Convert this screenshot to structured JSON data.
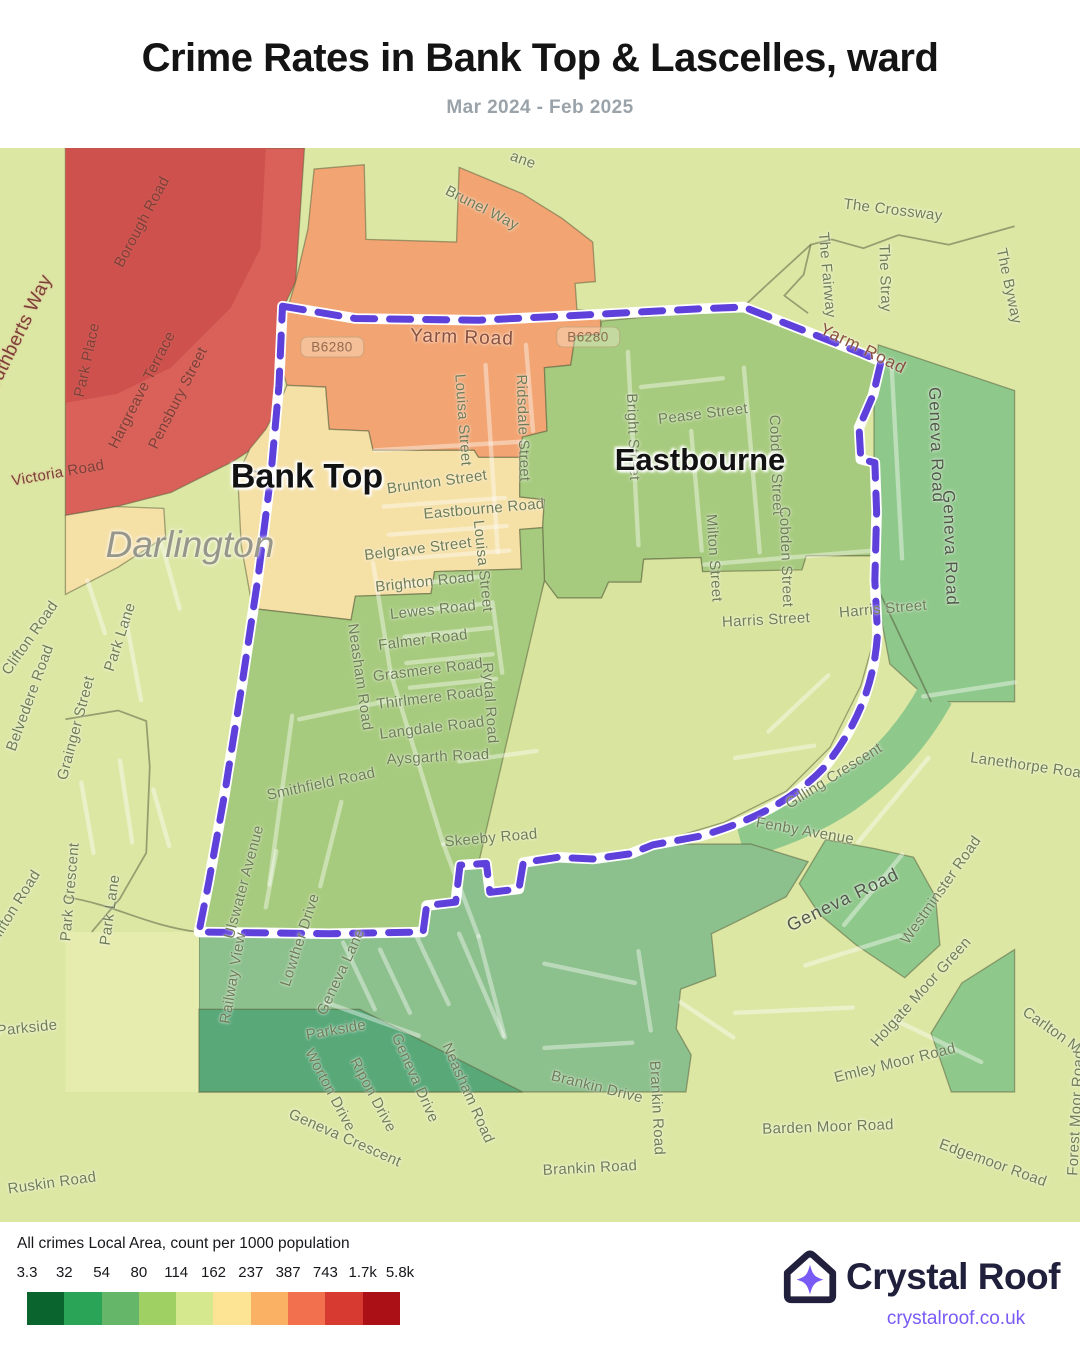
{
  "header": {
    "title": "Crime Rates in Bank Top & Lascelles, ward",
    "subtitle": "Mar 2024 - Feb 2025"
  },
  "legend": {
    "caption": "All crimes Local Area, count per 1000 population",
    "ticks": [
      "3.3",
      "32",
      "54",
      "80",
      "114",
      "162",
      "237",
      "387",
      "743",
      "1.7k",
      "5.8k"
    ],
    "colors": [
      "#0a642e",
      "#2aa457",
      "#65b669",
      "#9ed064",
      "#d6e88d",
      "#fce494",
      "#fbb163",
      "#f2704d",
      "#d63a31",
      "#aa1016"
    ]
  },
  "branding": {
    "name": "Crystal Roof",
    "url": "crystalroof.co.uk",
    "accent": "#7a5af5",
    "navy": "#20203c"
  },
  "map": {
    "palette": {
      "bg": "#dde7a4",
      "bg_soft": "#d9e49e",
      "red": "#d96159",
      "red_dark": "#cb4f4b",
      "orange": "#f2a573",
      "cream": "#f5e0a6",
      "green_mid": "#a7cb7e",
      "green_dark": "#8fc88b",
      "sage": "#8cc08c",
      "teal": "#58a878",
      "pale": "#e6ecae"
    },
    "boundary": {
      "line": "#5536d9",
      "casing": "#ffffff"
    },
    "place_labels": [
      {
        "t": "Bank Top",
        "x": 307,
        "y": 477,
        "s": 34,
        "v": ""
      },
      {
        "t": "Eastbourne",
        "x": 700,
        "y": 460,
        "s": 31,
        "v": ""
      },
      {
        "t": "Darlington",
        "x": 190,
        "y": 545,
        "s": 37,
        "v": "city"
      }
    ],
    "route_chips": [
      {
        "t": "B6280",
        "x": 332,
        "y": 347
      },
      {
        "t": "B6280",
        "x": 588,
        "y": 337
      }
    ],
    "street_labels": [
      {
        "t": "Borough Road",
        "x": 142,
        "y": 222,
        "r": -62,
        "v": "red"
      },
      {
        "t": "St Cuthberts Way",
        "x": 14,
        "y": 345,
        "r": -64,
        "v": "red",
        "s": 19
      },
      {
        "t": "Park Place",
        "x": 87,
        "y": 360,
        "r": -78,
        "v": "red"
      },
      {
        "t": "Hargreave Terrace",
        "x": 142,
        "y": 390,
        "r": -63,
        "v": "red"
      },
      {
        "t": "Pensbury Street",
        "x": 178,
        "y": 398,
        "r": -63,
        "v": "red"
      },
      {
        "t": "Victoria Road",
        "x": 58,
        "y": 473,
        "r": -10,
        "v": "red"
      },
      {
        "t": "Brunel Way",
        "x": 482,
        "y": 208,
        "r": 27
      },
      {
        "t": "ane",
        "x": 523,
        "y": 160,
        "r": 20
      },
      {
        "t": "Yarm Road",
        "x": 462,
        "y": 338,
        "r": 2,
        "v": "majorwarm"
      },
      {
        "t": "Yarm Road",
        "x": 863,
        "y": 349,
        "r": 26,
        "v": "majorwarm",
        "s": 17
      },
      {
        "t": "Louisa Street",
        "x": 463,
        "y": 420,
        "r": 86
      },
      {
        "t": "Louisa Street",
        "x": 483,
        "y": 566,
        "r": 84
      },
      {
        "t": "Ridsdale Street",
        "x": 523,
        "y": 428,
        "r": 88
      },
      {
        "t": "Brunton Street",
        "x": 437,
        "y": 482,
        "r": -8
      },
      {
        "t": "The Crossway",
        "x": 893,
        "y": 210,
        "r": 7
      },
      {
        "t": "The Fairway",
        "x": 827,
        "y": 275,
        "r": 85
      },
      {
        "t": "The Stray",
        "x": 885,
        "y": 278,
        "r": 88
      },
      {
        "t": "The Byway",
        "x": 1009,
        "y": 286,
        "r": 78
      },
      {
        "t": "Pease Street",
        "x": 703,
        "y": 414,
        "r": -7
      },
      {
        "t": "Bright Street",
        "x": 633,
        "y": 437,
        "r": 88
      },
      {
        "t": "Cobden Street",
        "x": 776,
        "y": 465,
        "r": 88
      },
      {
        "t": "Cobden Street",
        "x": 786,
        "y": 557,
        "r": 88
      },
      {
        "t": "Milton Street",
        "x": 714,
        "y": 558,
        "r": 86
      },
      {
        "t": "Eastbourne Road",
        "x": 484,
        "y": 509,
        "r": -5
      },
      {
        "t": "Belgrave Street",
        "x": 418,
        "y": 549,
        "r": -7
      },
      {
        "t": "Brighton Road",
        "x": 425,
        "y": 582,
        "r": -6
      },
      {
        "t": "Lewes Road",
        "x": 433,
        "y": 610,
        "r": -6
      },
      {
        "t": "Harris Street",
        "x": 766,
        "y": 620,
        "r": -3
      },
      {
        "t": "Harris Street",
        "x": 883,
        "y": 609,
        "r": -5
      },
      {
        "t": "Geneva Road",
        "x": 936,
        "y": 445,
        "r": 88,
        "v": "majordark"
      },
      {
        "t": "Geneva Road",
        "x": 950,
        "y": 548,
        "r": 88,
        "v": "majordark"
      },
      {
        "t": "Falmer Road",
        "x": 423,
        "y": 640,
        "r": -7
      },
      {
        "t": "Grasmere Road",
        "x": 428,
        "y": 670,
        "r": -7
      },
      {
        "t": "Thirlmere Road",
        "x": 430,
        "y": 698,
        "r": -7
      },
      {
        "t": "Langdale Road",
        "x": 432,
        "y": 728,
        "r": -7
      },
      {
        "t": "Aysgarth Road",
        "x": 438,
        "y": 757,
        "r": -3
      },
      {
        "t": "Neasham Road",
        "x": 360,
        "y": 677,
        "r": 82
      },
      {
        "t": "Rydal Road",
        "x": 490,
        "y": 703,
        "r": 86
      },
      {
        "t": "Smithfield Road",
        "x": 321,
        "y": 784,
        "r": -12
      },
      {
        "t": "Skeeby Road",
        "x": 491,
        "y": 838,
        "r": -5
      },
      {
        "t": "Ulswater Avenue",
        "x": 244,
        "y": 882,
        "r": -75
      },
      {
        "t": "Lowther Drive",
        "x": 300,
        "y": 940,
        "r": -72
      },
      {
        "t": "Railway View",
        "x": 233,
        "y": 978,
        "r": -80
      },
      {
        "t": "Geneva Lane",
        "x": 341,
        "y": 972,
        "r": -65
      },
      {
        "t": "Clifton Road",
        "x": 30,
        "y": 638,
        "r": -55
      },
      {
        "t": "Belvedere Road",
        "x": 30,
        "y": 698,
        "r": -70
      },
      {
        "t": "Grainger Street",
        "x": 76,
        "y": 728,
        "r": -75
      },
      {
        "t": "Park Lane",
        "x": 120,
        "y": 637,
        "r": -72
      },
      {
        "t": "Park Lane",
        "x": 110,
        "y": 910,
        "r": -82
      },
      {
        "t": "Park Crescent",
        "x": 70,
        "y": 892,
        "r": -85
      },
      {
        "t": "Clifton Road",
        "x": 14,
        "y": 908,
        "r": -58
      },
      {
        "t": "Parkside",
        "x": 27,
        "y": 1028,
        "r": -6
      },
      {
        "t": "Parkside",
        "x": 336,
        "y": 1030,
        "r": -10
      },
      {
        "t": "Worton Drive",
        "x": 330,
        "y": 1090,
        "r": 62
      },
      {
        "t": "Ripon Drive",
        "x": 373,
        "y": 1095,
        "r": 62
      },
      {
        "t": "Geneva Drive",
        "x": 415,
        "y": 1078,
        "r": 66
      },
      {
        "t": "Neasham Road",
        "x": 468,
        "y": 1093,
        "r": 66
      },
      {
        "t": "Geneva Crescent",
        "x": 345,
        "y": 1138,
        "r": 24
      },
      {
        "t": "Brankin Drive",
        "x": 597,
        "y": 1087,
        "r": 14
      },
      {
        "t": "Brankin Road",
        "x": 657,
        "y": 1108,
        "r": 87
      },
      {
        "t": "Brankin Road",
        "x": 590,
        "y": 1168,
        "r": -3
      },
      {
        "t": "Ruskin Road",
        "x": 52,
        "y": 1183,
        "r": -8
      },
      {
        "t": "Gilling Crescent",
        "x": 834,
        "y": 776,
        "r": -32
      },
      {
        "t": "Fenby Avenue",
        "x": 805,
        "y": 831,
        "r": 10
      },
      {
        "t": "Geneva Road",
        "x": 843,
        "y": 900,
        "r": -26,
        "v": "majordark",
        "s": 18
      },
      {
        "t": "Lanethorpe Road",
        "x": 1030,
        "y": 766,
        "r": 8
      },
      {
        "t": "Westminster Road",
        "x": 941,
        "y": 890,
        "r": -55
      },
      {
        "t": "Holgate Moor Green",
        "x": 921,
        "y": 992,
        "r": -48
      },
      {
        "t": "Emley Moor Road",
        "x": 895,
        "y": 1063,
        "r": -14
      },
      {
        "t": "Carlton M",
        "x": 1052,
        "y": 1030,
        "r": 35
      },
      {
        "t": "Forest Moor Road",
        "x": 1076,
        "y": 1113,
        "r": -87
      },
      {
        "t": "Edgemoor Road",
        "x": 993,
        "y": 1163,
        "r": 20
      },
      {
        "t": "Barden Moor Road",
        "x": 828,
        "y": 1127,
        "r": -2
      }
    ]
  }
}
